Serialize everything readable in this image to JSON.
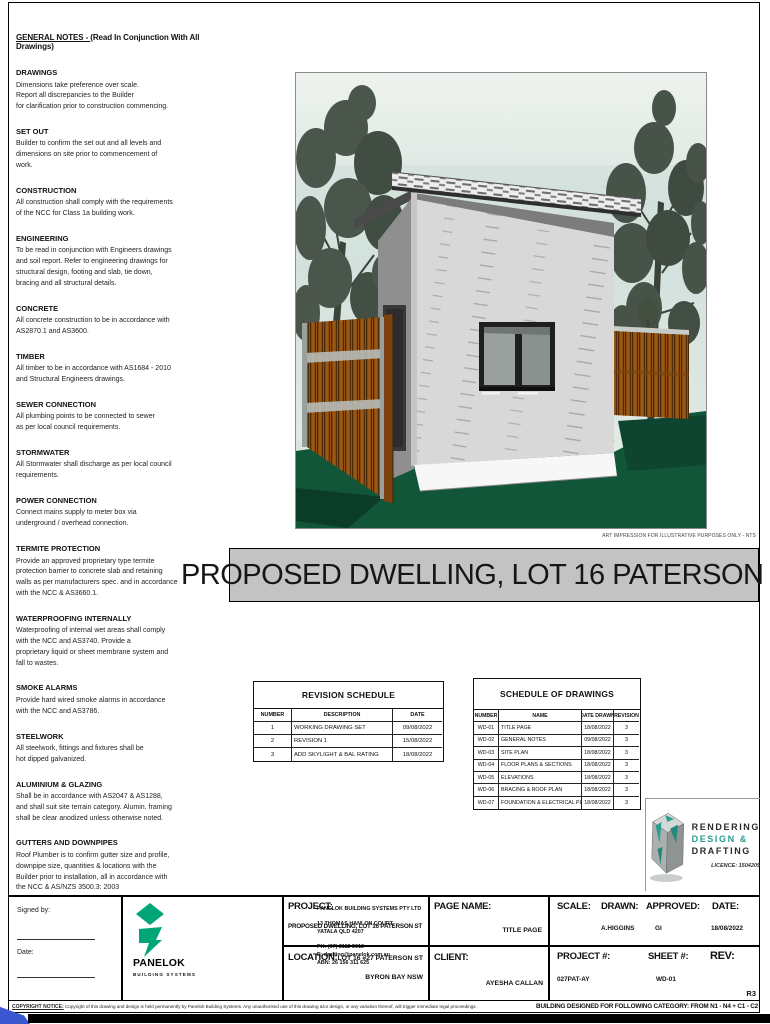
{
  "page": {
    "title_banner": "PROPOSED DWELLING, LOT 16 PATERSON ST",
    "art_caption": "ART IMPRESSION FOR ILLUSTRATIVE PURPOSES ONLY - NTS",
    "copyright_label": "COPYRIGHT NOTICE:",
    "copyright_text": "Copyright of this drawing and design is held permanently by Panelok Building Systems. Any unauthorised use of this drawing &/or design, or any variation thereof, will trigger immediate legal proceedings.",
    "category_note": "BUILDING DESIGNED FOR FOLLOWING CATEGORY: FROM N1 - N4 + C1 - C2"
  },
  "notes": {
    "heading": "GENERAL NOTES - ",
    "heading_suffix": "(Read In Conjunction With All Drawings)",
    "sections": [
      {
        "title": "DRAWINGS",
        "body": "Dimensions take preference over scale.\nReport all discrepancies to the Builder\nfor clarification prior to construction commencing."
      },
      {
        "title": "SET OUT",
        "body": "Builder to confirm the set out and all levels and\ndimensions on site prior to commencement of\nwork."
      },
      {
        "title": "CONSTRUCTION",
        "body": "All construction shall comply with the requirements\nof the NCC for Class 1a building work."
      },
      {
        "title": "ENGINEERING",
        "body": "To be read in conjunction with Engineers drawings\nand soil report. Refer to engineering drawings for\nstructural design, footing and slab, tie down,\nbracing and all structural details."
      },
      {
        "title": "CONCRETE",
        "body": "All concrete construction to be in accordance with\nAS2870.1 and AS3600."
      },
      {
        "title": "TIMBER",
        "body": "All timber to be in accordance with AS1684 - 2010\nand Structural Engineers drawings."
      },
      {
        "title": "SEWER CONNECTION",
        "body": "All plumbing points to be connected to sewer\nas per local council requirements."
      },
      {
        "title": "STORMWATER",
        "body": "All Stormwater shall discharge as per local council\nrequirements."
      },
      {
        "title": "POWER CONNECTION",
        "body": "Connect mains supply to meter box via\nunderground / overhead connection."
      },
      {
        "title": "TERMITE PROTECTION",
        "body": "Provide an approved proprietary type termite\nprotection barrier to concrete slab and retaining\nwalls as per manufacturers spec. and in accordance\nwith the NCC & AS3660.1."
      },
      {
        "title": "WATERPROOFING INTERNALLY",
        "body": "Waterproofing of internal wet areas shall comply\nwith the NCC and AS3740. Provide a\nproprietary liquid or sheet membrane system and\nfall to wastes."
      },
      {
        "title": "SMOKE ALARMS",
        "body": "Provide hard wired smoke alarms in accordance\nwith the NCC and AS3786."
      },
      {
        "title": "STEELWORK",
        "body": "All steelwork, fittings and fixtures shall be\nhot dipped galvanized."
      },
      {
        "title": "ALUMINIUM & GLAZING",
        "body": "Shall be in accordance with AS2047 & AS1288,\nand shall suit site terrain category. Alumin. framing\nshall be clear anodized unless otherwise noted."
      },
      {
        "title": "GUTTERS AND DOWNPIPES",
        "body": "Roof Plumber is to confirm gutter size and profile,\ndownpipe size, quantities & locations with the\nBuilder prior to installation, all in accordance with\nthe NCC & AS/NZS 3500.3: 2003"
      }
    ]
  },
  "revision_schedule": {
    "title": "REVISION SCHEDULE",
    "headers": [
      "NUMBER",
      "DESCRIPTION",
      "DATE"
    ],
    "rows": [
      [
        "1",
        "WORKING DRAWING SET",
        "09/08/2022"
      ],
      [
        "2",
        "REVISION 1",
        "15/08/2022"
      ],
      [
        "3",
        "ADD SKYLIGHT & BAL RATING",
        "18/08/2022"
      ]
    ]
  },
  "schedule_of_drawings": {
    "title": "SCHEDULE OF DRAWINGS",
    "headers": [
      "NUMBER",
      "NAME",
      "DATE DRAWN",
      "REVISION"
    ],
    "rows": [
      [
        "WD-01",
        "TITLE PAGE",
        "18/08/2022",
        "3"
      ],
      [
        "WD-02",
        "GENERAL NOTES",
        "09/08/2022",
        "3"
      ],
      [
        "WD-03",
        "SITE PLAN",
        "18/08/2022",
        "3"
      ],
      [
        "WD-04",
        "FLOOR PLANS & SECTIONS",
        "18/08/2022",
        "3"
      ],
      [
        "WD-05",
        "ELEVATIONS",
        "18/08/2022",
        "3"
      ],
      [
        "WD-06",
        "BRACING & ROOF PLAN",
        "18/08/2022",
        "3"
      ],
      [
        "WD-07",
        "FOUNDATION & ELECTRICAL PLANS",
        "18/08/2022",
        "3"
      ]
    ]
  },
  "rdd_logo": {
    "line1": "RENDERING",
    "line2": "DESIGN &",
    "line3": "DRAFTING",
    "licence": "LICENCE: 1504205",
    "accent": "#2a9d8f"
  },
  "titleblock": {
    "signed_by": "Signed by:",
    "date_label": "Date:",
    "company": {
      "name": "PANELOK BUILDING SYSTEMS PTY LTD",
      "address1": "13 THOMAS HANLON COURT,",
      "address2": "YATALA QLD 4207",
      "phone": "PH: (07) 2112 5018",
      "email": "E: drafting@panelok.com.au",
      "abn": "ABN: 26 156 311 625",
      "logo_text": "PANELOK",
      "logo_sub": "BUILDING SYSTEMS",
      "logo_color": "#00a578"
    },
    "fields": {
      "project_label": "PROJECT:",
      "project_value": "PROPOSED DWELLING, LOT 16 PATERSON ST",
      "page_name_label": "PAGE NAME:",
      "page_name_value": "TITLE PAGE",
      "scale_label": "SCALE:",
      "drawn_label": "DRAWN:",
      "drawn_value": "A.HIGGINS",
      "approved_label": "APPROVED:",
      "approved_value": "GI",
      "date_label": "DATE:",
      "date_value": "18/08/2022",
      "location_label": "LOCATION:",
      "location_value1": "LOT 16 #27 PATERSON ST",
      "location_value2": "BYRON BAY NSW",
      "client_label": "CLIENT:",
      "client_value": "AYESHA CALLAN",
      "project_no_label": "PROJECT #:",
      "project_no_value": "027PAT-AY",
      "sheet_label": "SHEET #:",
      "sheet_value": "WD-01",
      "rev_label": "REV:",
      "rev_value": "R3"
    }
  }
}
